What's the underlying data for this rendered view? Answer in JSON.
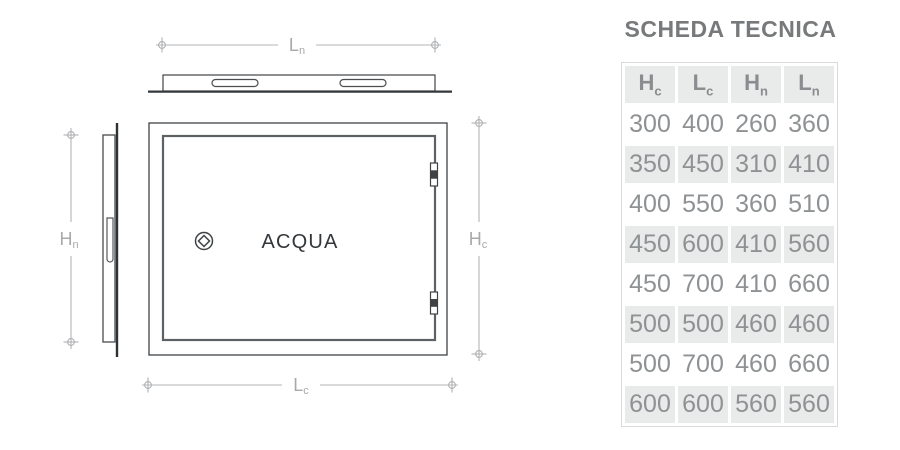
{
  "panel": {
    "title": "SCHEDA TECNICA"
  },
  "drawing": {
    "door_label": "ACQUA",
    "dims": {
      "ln": {
        "main": "L",
        "sub": "n"
      },
      "lc": {
        "main": "L",
        "sub": "c"
      },
      "hn": {
        "main": "H",
        "sub": "n"
      },
      "hc": {
        "main": "H",
        "sub": "c"
      }
    },
    "icons": {
      "lock": "circle-diamond-lock",
      "hinges": "door-hinge"
    }
  },
  "table": {
    "headers": [
      {
        "main": "H",
        "sub": "c"
      },
      {
        "main": "L",
        "sub": "c"
      },
      {
        "main": "H",
        "sub": "n"
      },
      {
        "main": "L",
        "sub": "n"
      }
    ],
    "rows": [
      [
        "300",
        "400",
        "260",
        "360"
      ],
      [
        "350",
        "450",
        "310",
        "410"
      ],
      [
        "400",
        "550",
        "360",
        "510"
      ],
      [
        "450",
        "600",
        "410",
        "560"
      ],
      [
        "450",
        "700",
        "410",
        "660"
      ],
      [
        "500",
        "500",
        "460",
        "460"
      ],
      [
        "500",
        "700",
        "460",
        "660"
      ],
      [
        "600",
        "600",
        "560",
        "560"
      ]
    ]
  },
  "colors": {
    "title_text": "#77797b",
    "table_text": "#8f9294",
    "row_alt_bg": "#e9eaea",
    "dimension_gray": "#b3b5b7",
    "drawing_dark": "#3f4346"
  }
}
